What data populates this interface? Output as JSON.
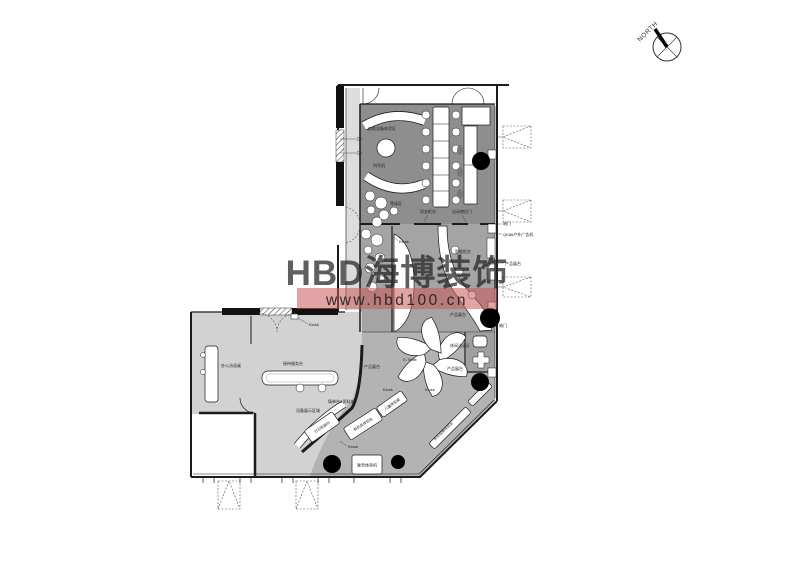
{
  "page": {
    "background": "#ffffff"
  },
  "north_arrow": {
    "label": "NORTH"
  },
  "watermark": {
    "brand": "HBD海博装饰",
    "url": "www.hbd100.cn",
    "band_color": "#c95757",
    "text_color": "#8a8a8a"
  },
  "plan": {
    "labels": {
      "self_service_area": "自助设备体验区",
      "ticket_machine": "叫号机",
      "waiting_area": "等候区",
      "cash_counter": "现金柜台",
      "auto_door": "自动感应门",
      "hidden_door": "暗门",
      "ad_screen": "QK86户外广告机",
      "product_booth": "产品展台",
      "smart_counter": "智能柜台",
      "kiosk": "Kiosk",
      "etable": "E-Table",
      "reception_desk": "接待服务台",
      "office_desk": "办公洽谈桌",
      "form_counter": "填单台&资料架",
      "device_display": "设备展示区域",
      "printer_booth": "打印机展台",
      "new_device": "新机具体验台",
      "children_table": "儿童体验桌",
      "holo_area": "全息成像体验区",
      "composite_machine": "复合体验机",
      "lounge": "休闲洽谈区"
    }
  }
}
